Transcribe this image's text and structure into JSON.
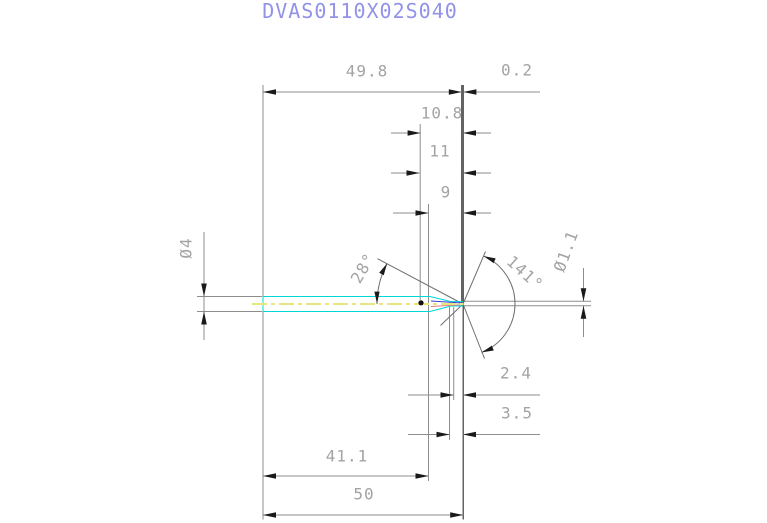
{
  "title": "DVAS0110X02S040",
  "dimensions": {
    "body_length": "49.8",
    "tip_back_offset": "0.2",
    "len_10_8": "10.8",
    "len_11": "11",
    "len_9": "9",
    "shank_diameter": "Ø4",
    "taper_angle": "28°",
    "point_angle": "141°",
    "drill_diameter": "Ø1.1",
    "len_2_4": "2.4",
    "len_3_5": "3.5",
    "len_41_1": "41.1",
    "overall_length": "50"
  },
  "colors": {
    "title_text": "#9292e8",
    "dimension_text": "#a3a3a3",
    "dimension_lines": "#8d8d8d",
    "dark_extension_line": "#3c3c3c",
    "arrowheads": "#1a1a1a",
    "part_outline": "#00d8d8",
    "centerline": "#e6e67c",
    "margin_line_blue": "#3c3cd2",
    "margin_line_red": "#e27d7d"
  }
}
